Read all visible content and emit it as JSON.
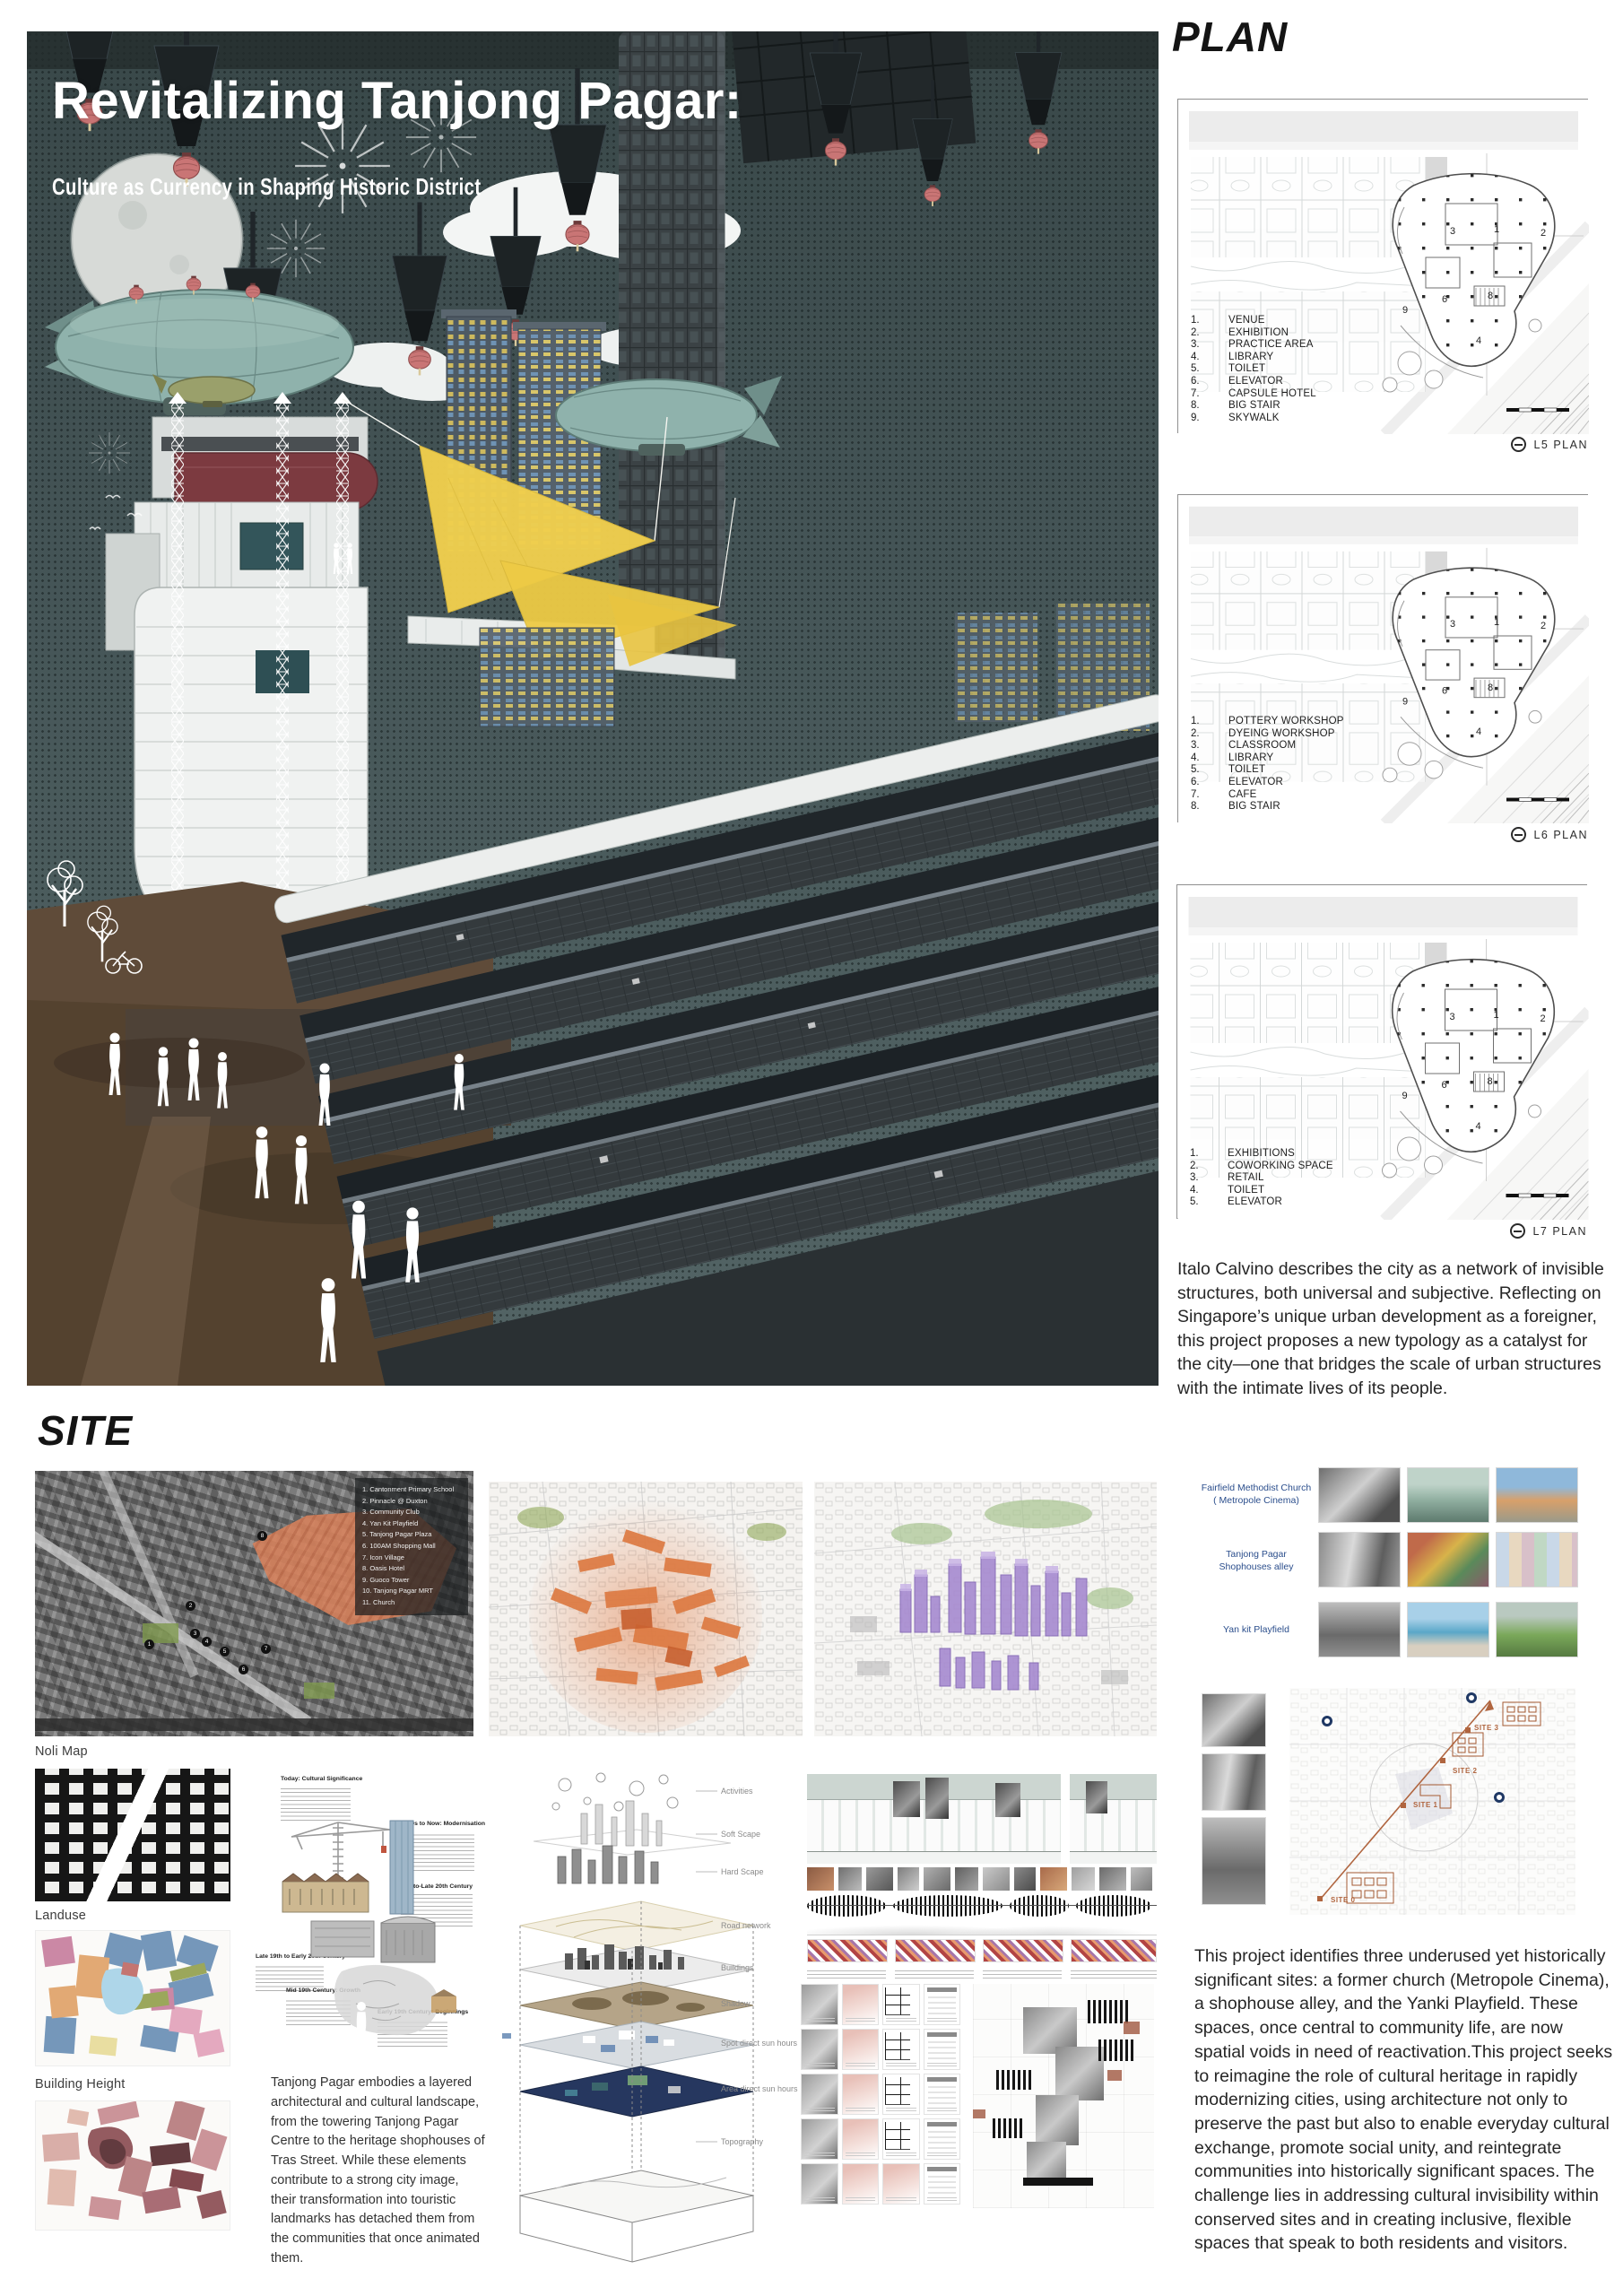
{
  "hero": {
    "title": "Revitalizing Tanjong Pagar:",
    "subtitle": "Culture as Currency in Shaping Historic District"
  },
  "plan": {
    "heading": "PLAN",
    "note": "Italo Calvino describes the city as a network of invisible structures, both universal and subjective. Reflecting on Singapore’s unique urban development as a foreigner, this project proposes a new typology as a catalyst for the city—one that bridges the scale of urban structures with the intimate lives of its people.",
    "plans": [
      {
        "caption": "L5 PLAN",
        "legend": [
          {
            "num": "1.",
            "label": "VENUE"
          },
          {
            "num": "2.",
            "label": "EXHIBITION"
          },
          {
            "num": "3.",
            "label": "PRACTICE AREA"
          },
          {
            "num": "4.",
            "label": "LIBRARY"
          },
          {
            "num": "5.",
            "label": "TOILET"
          },
          {
            "num": "6.",
            "label": "ELEVATOR"
          },
          {
            "num": "7.",
            "label": "CAPSULE HOTEL"
          },
          {
            "num": "8.",
            "label": "BIG STAIR"
          },
          {
            "num": "9.",
            "label": "SKYWALK"
          }
        ]
      },
      {
        "caption": "L6 PLAN",
        "legend": [
          {
            "num": "1.",
            "label": "POTTERY WORKSHOP"
          },
          {
            "num": "2.",
            "label": "DYEING WORKSHOP"
          },
          {
            "num": "3.",
            "label": "CLASSROOM"
          },
          {
            "num": "4.",
            "label": "LIBRARY"
          },
          {
            "num": "5.",
            "label": "TOILET"
          },
          {
            "num": "6.",
            "label": "ELEVATOR"
          },
          {
            "num": "7.",
            "label": "CAFE"
          },
          {
            "num": "8.",
            "label": "BIG STAIR"
          }
        ]
      },
      {
        "caption": "L7 PLAN",
        "legend": [
          {
            "num": "1.",
            "label": "EXHIBITIONS"
          },
          {
            "num": "2.",
            "label": "COWORKING SPACE"
          },
          {
            "num": "3.",
            "label": "RETAIL"
          },
          {
            "num": "4.",
            "label": "TOILET"
          },
          {
            "num": "5.",
            "label": "ELEVATOR"
          }
        ]
      }
    ]
  },
  "site": {
    "heading": "SITE",
    "map_labels": {
      "noli": "Noli Map",
      "landuse": "Landuse",
      "building_height": "Building Height"
    },
    "satellite_legend": [
      "1. Cantonment Primary School",
      "2. Pinnacle @ Duxton",
      "3. Community Club",
      "4. Yan Kit Playfield",
      "5. Tanjong Pagar Plaza",
      "6. 100AM Shopping Mall",
      "7. Icon Village",
      "8. Oasis Hotel",
      "9. Guoco Tower",
      "10. Tanjong Pagar MRT",
      "11. Church"
    ],
    "sat_markers": [
      "1",
      "2",
      "3",
      "4",
      "5",
      "6",
      "7",
      "8"
    ],
    "timeline": [
      {
        "title": "Today: Cultural Significance"
      },
      {
        "title": "1980s to Now: Modernisation"
      },
      {
        "title": "Mid-to-Late 20th Century"
      },
      {
        "title": "Late 19th to Early 20th Century"
      },
      {
        "title": "Mid 19th Century: Growth"
      },
      {
        "title": "Early 19th Century: Beginnings"
      }
    ],
    "left_paragraph": "Tanjong Pagar embodies a layered architectural and cultural landscape, from the towering Tanjong Pagar Centre to the heritage shophouses of Tras Street. While these elements contribute to a strong city image, their transformation into touristic landmarks has detached them from the communities that once animated them.",
    "axon_labels": [
      "Activities",
      "Soft Scape",
      "Hard Scape",
      "Road network",
      "Buildings",
      "Shadow",
      "Spot direct sun hours",
      "Area direct sun hours",
      "Topography"
    ],
    "photo_rows": [
      {
        "line1": "Fairfield Methodist Church",
        "line2": "( Metropole Cinema)"
      },
      {
        "line1": "Tanjong Pagar",
        "line2": "Shophouses alley"
      },
      {
        "line1": "Yan kit Playfield",
        "line2": ""
      }
    ],
    "sitemap_labels": [
      "SITE 0",
      "SITE 1",
      "SITE 2",
      "SITE 3"
    ],
    "right_paragraph": "This project identifies three underused yet historically significant sites: a former church (Metropole Cinema), a shophouse alley, and the Yanki Playfield. These spaces, once central to community life, are now spatial voids in need of reactivation.This project seeks to reimagine the role of cultural heritage in rapidly modernizing cities, using architecture not only to preserve the past but also to enable everyday cultural exchange, promote social unity, and reintegrate communities into historically significant spaces. The challenge lies in addressing cultural invisibility within conserved sites and in creating inclusive, flexible spaces that speak to both residents and visitors."
  },
  "colors": {
    "hero_teal": "#44545 6",
    "sail_yellow": "#f0cf4e",
    "accent_orange": "#b0653f",
    "label_blue": "#2b4e8c"
  }
}
